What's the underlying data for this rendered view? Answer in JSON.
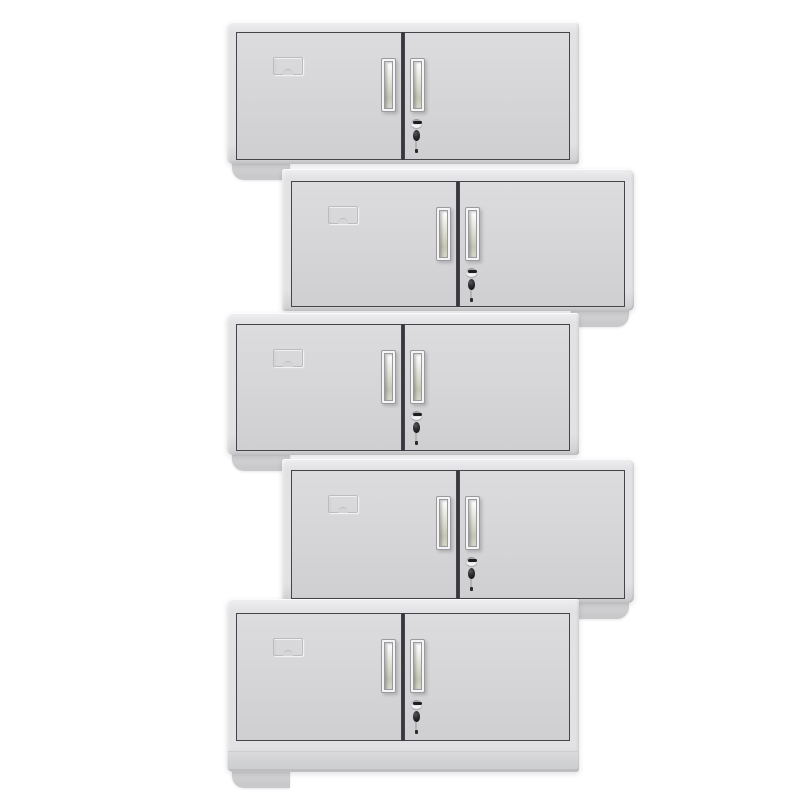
{
  "scene": {
    "description": "Product photo: five light-grey two-door steel office cupboards stacked in an alternating left/right zig-zag tower on a white background",
    "unit_count": 5,
    "background_color": "#ffffff"
  },
  "colors": {
    "background": "#ffffff",
    "frame": "#e2e2e4",
    "frame_light": "#efeff1",
    "frame_dark": "#cdcdcf",
    "edge_line": "#bdbdbf",
    "door": "#d5d5d7",
    "door_light": "#dcdcde",
    "door_dark": "#cfcfd1",
    "door_border": "#44444a",
    "gap": "#37373d",
    "emboss_line": "#bcbcbe",
    "handle_frame": "#f5f5f7",
    "handle_border": "#9a9a9c",
    "recess_top": "#ecece6",
    "recess_bottom": "#c6c6b6",
    "lock_slot": "#1d1d21",
    "key_stem": "#b4b4b6",
    "base_top": "#d8d8da",
    "base_bottom": "#c9c9cb",
    "plinth_top": "#dadadc",
    "plinth_bottom": "#cecfd1"
  },
  "units": [
    {
      "name": "cabinet-1",
      "side": "left",
      "x": 227,
      "y": 22,
      "w": 352,
      "h": 142,
      "door_top": 10,
      "door_bottom": 4,
      "plinth": false
    },
    {
      "name": "cabinet-2",
      "side": "right",
      "x": 282,
      "y": 169,
      "w": 352,
      "h": 142,
      "door_top": 12,
      "door_bottom": 4,
      "plinth": false
    },
    {
      "name": "cabinet-3",
      "side": "left",
      "x": 227,
      "y": 313,
      "w": 352,
      "h": 142,
      "door_top": 11,
      "door_bottom": 4,
      "plinth": false
    },
    {
      "name": "cabinet-4",
      "side": "right",
      "x": 282,
      "y": 459,
      "w": 352,
      "h": 144,
      "door_top": 11,
      "door_bottom": 4,
      "plinth": false
    },
    {
      "name": "cabinet-5",
      "side": "left",
      "x": 227,
      "y": 599,
      "w": 352,
      "h": 173,
      "door_top": 14,
      "door_bottom": 31,
      "plinth": true
    }
  ],
  "unit_features": {
    "doors_per_unit": 2,
    "handles_per_unit": 2,
    "lock": "cylinder lock with hanging key on right door",
    "label_holder": "embossed card holder on upper-left of left door"
  }
}
